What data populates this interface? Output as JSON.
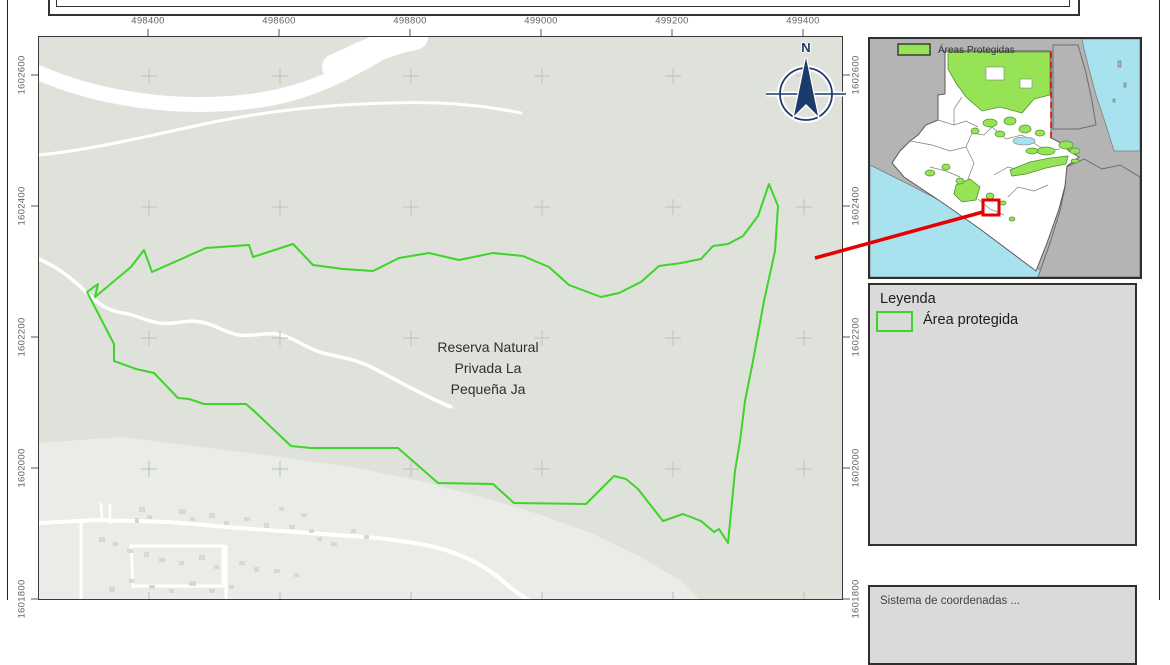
{
  "page": {
    "title_box_text": ""
  },
  "map": {
    "label": [
      "Reserva Natural",
      "Privada La",
      "Pequeña Ja"
    ]
  },
  "axis": {
    "top_labels": [
      "498400",
      "498600",
      "498800",
      "499000",
      "499200",
      "499400"
    ],
    "side_labels": [
      "1602600",
      "1602400",
      "1602200",
      "1602000",
      "1601800"
    ]
  },
  "north_arrow": {
    "label": "N"
  },
  "inset": {
    "legend_label": "Áreas Protegidas"
  },
  "legend": {
    "title": "Leyenda",
    "items": [
      {
        "label": "Área protegida",
        "swatch": "green-outline-rect"
      }
    ]
  },
  "info_box": {
    "text": "Sistema de coordenadas ..."
  },
  "colors": {
    "map_bg": "#dee2da",
    "urban": "#eaece8",
    "road": "#ffffff",
    "building": "#d6d9d3",
    "reserve_green": "#3ed429",
    "grid_cross": "#c3c8c0",
    "box_bg": "#dadada",
    "inset_land_gray": "#b4b4b4",
    "water": "#a9e2ef",
    "guatemala_fill": "#ffffff",
    "dept_border": "#7f7f7f",
    "protected_fill": "#97e356",
    "protected_stroke": "#4e9032",
    "highlight_red": "#e60000",
    "navy": "#1c3a6b"
  },
  "map_geometry": {
    "frame": {
      "left": 38,
      "top": 36,
      "width": 805,
      "height": 564
    },
    "grid_x": [
      110,
      241,
      372,
      503,
      634,
      765
    ],
    "grid_y": [
      39,
      170,
      301,
      432,
      563
    ],
    "urban_polygon": "0,406 82,400 162,410 242,420 312,430 382,444 442,460 502,478 552,496 602,520 642,544 662,564 0,564",
    "reserve_polygon": "48,255 59,247 56,260 92,230 105,213 113,235 167,211 210,208 214,220 254,207 274,228 304,232 334,234 360,221 390,216 420,223 454,216 484,219 510,230 530,248 562,260 580,256 602,245 620,229 642,226 662,222 674,209 689,207 704,199 719,179 730,147 739,169 736,214 725,264 714,324 706,364 701,404 696,434 689,506 680,492 675,495 662,484 644,477 624,484 599,452 587,442 575,439 547,467 475,466 454,447 399,446 359,411 272,411 252,409 215,374 207,367 165,367 150,362 139,361 115,336 97,332 75,324 75,307",
    "roads": [
      {
        "d": "M 0 36 C 60 62 140 74 215 64 C 275 56 315 32 368 0",
        "w": 15
      },
      {
        "d": "M 296 30 C 330 14 352 4 376 0",
        "w": 26
      },
      {
        "d": "M 0 118 C 60 112 120 96 180 84 C 240 72 320 64 400 66 C 440 68 462 72 482 76",
        "w": 3
      },
      {
        "d": "M 0 222 C 18 230 34 242 47 255 C 60 268 70 274 84 276 C 98 278 106 284 120 286 C 136 288 148 282 162 285 C 178 288 186 296 200 298 C 216 300 228 294 242 298 C 258 302 268 312 284 316 C 300 320 316 322 332 330 C 348 338 362 346 378 354 C 394 362 402 366 412 370",
        "w": 3.5
      },
      {
        "d": "M 0 486 L 60 483 L 130 485 L 200 491 L 270 496 L 340 501 L 382 507 C 415 513 445 527 465 545 C 477 556 485 560 491 564",
        "w": 4
      },
      {
        "d": "M 42 483 L 42 564",
        "w": 3
      },
      {
        "d": "M 62 467 L 63 485",
        "w": 2.5
      },
      {
        "d": "M 71 468 L 71 486",
        "w": 2.5
      },
      {
        "d": "M 92 509 L 184 509 L 184 549 L 94 549 L 92 509",
        "w": 3
      },
      {
        "d": "M 187 509 L 187 564",
        "w": 3
      }
    ],
    "buildings": [
      [
        100,
        470,
        6,
        5
      ],
      [
        108,
        478,
        5,
        4
      ],
      [
        96,
        481,
        4,
        5
      ],
      [
        140,
        472,
        7,
        5
      ],
      [
        151,
        480,
        5,
        4
      ],
      [
        170,
        476,
        6,
        5
      ],
      [
        185,
        484,
        5,
        4
      ],
      [
        205,
        480,
        6,
        4
      ],
      [
        225,
        486,
        5,
        5
      ],
      [
        250,
        488,
        6,
        4
      ],
      [
        270,
        492,
        5,
        4
      ],
      [
        60,
        500,
        6,
        5
      ],
      [
        74,
        505,
        5,
        4
      ],
      [
        88,
        512,
        6,
        4
      ],
      [
        105,
        515,
        5,
        5
      ],
      [
        120,
        521,
        6,
        4
      ],
      [
        140,
        524,
        5,
        4
      ],
      [
        160,
        518,
        6,
        5
      ],
      [
        175,
        528,
        5,
        4
      ],
      [
        200,
        524,
        6,
        4
      ],
      [
        215,
        530,
        5,
        5
      ],
      [
        235,
        532,
        6,
        4
      ],
      [
        255,
        536,
        5,
        4
      ],
      [
        150,
        544,
        7,
        5
      ],
      [
        130,
        552,
        5,
        4
      ],
      [
        110,
        548,
        6,
        4
      ],
      [
        90,
        542,
        5,
        4
      ],
      [
        70,
        550,
        6,
        5
      ],
      [
        170,
        552,
        6,
        4
      ],
      [
        190,
        548,
        5,
        4
      ],
      [
        278,
        500,
        5,
        4
      ],
      [
        292,
        505,
        6,
        4
      ],
      [
        240,
        470,
        5,
        4
      ],
      [
        262,
        476,
        6,
        4
      ],
      [
        312,
        492,
        5,
        4
      ],
      [
        325,
        498,
        5,
        4
      ]
    ]
  },
  "overlay_geometry": {
    "top_tick_y": [
      29,
      36
    ],
    "left_tick_x": [
      31,
      38
    ],
    "right_tick_x": [
      843,
      850
    ],
    "red_leader": {
      "x1": 815,
      "y1": 258,
      "x2": 983,
      "y2": 212
    }
  },
  "inset_geometry": {
    "pacific": "0,126 40,146 90,172 140,205 178,238 0,238",
    "caribbean": "212,0 270,0 270,112 244,112 236,86 226,56 218,26 214,10",
    "belize": "183,6 208,6 216,34 222,62 226,86 208,90 183,90",
    "southeast_land": "196,128 214,120 232,130 250,126 270,138 270,238 168,238 180,204 190,172 195,148",
    "guatemala": "75,12 181,12 181,99 191,104 199,112 209,118 197,127 195,147 189,170 177,204 166,232 150,220 110,190 70,162 34,138 22,124 30,112 40,102 48,96 56,86 68,81 68,56 75,55",
    "dept_lines": [
      "M 40 102 L 62 106 L 80 112 L 96 108",
      "M 68 81 L 84 86 L 96 82 L 108 88",
      "M 96 108 L 102 94 L 114 96 L 122 88",
      "M 96 108 L 104 124 L 98 140 L 106 156",
      "M 122 88 L 136 100 L 152 96 L 164 104",
      "M 124 136 L 138 128 L 154 132 L 168 124",
      "M 138 158 L 148 148 L 164 152 L 178 146",
      "M 164 104 L 176 112 L 190 110",
      "M 60 128 L 76 132 L 90 138",
      "M 108 160 L 120 170 L 134 176",
      "M 84 86 L 84 70 L 92 58",
      "M 100 30 L 120 36 L 142 32",
      "M 156 14 L 158 40",
      "M 146 58 L 166 56"
    ],
    "peten_green": "78,13 180,13 180,56 164,60 152,74 130,68 112,72 96,58 86,44 78,30",
    "peten_holes": [
      [
        116,
        28,
        18,
        13
      ],
      [
        150,
        40,
        12,
        9
      ]
    ],
    "minas_green": "140,131 160,123 180,119 198,117 196,125 176,129 156,135 142,137",
    "sw_green": "86,146 100,140 110,148 106,161 92,163 84,155",
    "green_blobs": [
      [
        120,
        84,
        7,
        4
      ],
      [
        140,
        82,
        6,
        4
      ],
      [
        155,
        90,
        6,
        4
      ],
      [
        130,
        95,
        5,
        3
      ],
      [
        105,
        92,
        4,
        3
      ],
      [
        170,
        94,
        5,
        3
      ],
      [
        176,
        112,
        9,
        4
      ],
      [
        196,
        106,
        7,
        4
      ],
      [
        205,
        112,
        5,
        3
      ],
      [
        162,
        112,
        6,
        3
      ],
      [
        60,
        134,
        5,
        3
      ],
      [
        76,
        128,
        4,
        3
      ],
      [
        90,
        142,
        4,
        3
      ],
      [
        120,
        157,
        4,
        3
      ],
      [
        133,
        164,
        3,
        2
      ],
      [
        142,
        180,
        3,
        2
      ],
      [
        205,
        122,
        4,
        2
      ]
    ],
    "lake": [
      154,
      102,
      11,
      4
    ],
    "islands": [
      [
        248,
        22,
        3,
        6
      ],
      [
        254,
        44,
        2,
        4
      ],
      [
        243,
        60,
        2,
        3
      ]
    ],
    "belize_red_dash": "M 181 13 L 181 100",
    "red_rect": [
      113,
      161,
      16,
      15
    ],
    "legend_swatch": [
      28,
      5,
      32,
      11
    ]
  }
}
